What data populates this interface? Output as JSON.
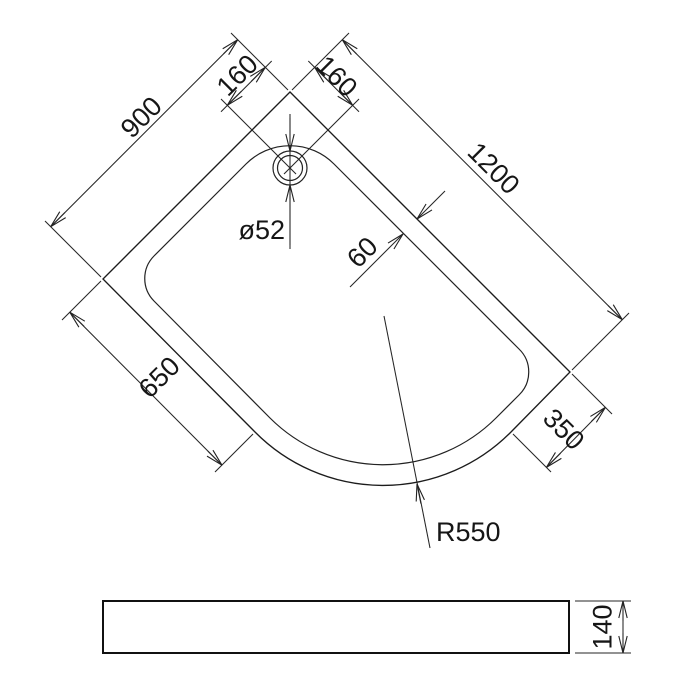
{
  "drawing_type": "technical dimension drawing — offset quadrant shower tray",
  "top_view": {
    "labels": {
      "edge_left": "900",
      "edge_right": "1200",
      "drain_offset_left": "160",
      "drain_offset_right": "160",
      "drain_diameter": "ø52",
      "rim_width": "60",
      "straight_edge_left": "650",
      "straight_edge_right": "350",
      "corner_radius": "R550"
    }
  },
  "side_view": {
    "labels": {
      "height": "140"
    }
  },
  "colors": {
    "line": "#1c1c1c",
    "background": "#ffffff"
  }
}
